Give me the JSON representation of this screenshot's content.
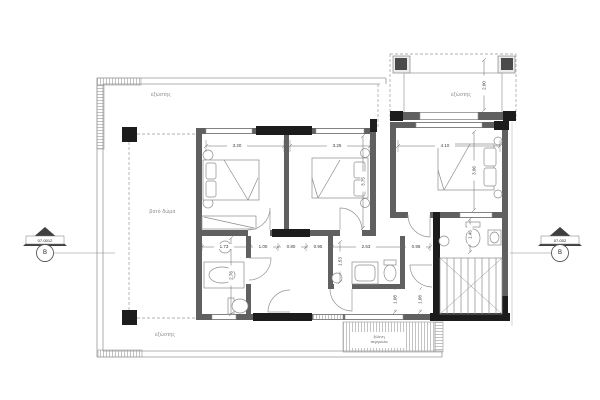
{
  "plan": {
    "labels": {
      "terrace_top": "εξώστης",
      "balcony": "εξώστης",
      "roof_deck": "βατό δώμα",
      "terrace_bottom": "εξώστης",
      "pergola_line1": "ξύλινη",
      "pergola_line2": "πέργκολα"
    },
    "section_markers": {
      "left": {
        "code": "07-0012",
        "letter": "Β"
      },
      "right": {
        "code": "07-002",
        "letter": "Β"
      }
    },
    "dimensions": {
      "bed1_width": "3.20",
      "bed2_width": "3.25",
      "bed3_width": "4.10",
      "balcony_depth": "2.00",
      "bed2_depth": "3.75",
      "bed3_depth": "3.06",
      "bath1_width": "1.73",
      "hall_1": "1.00",
      "hall_2": "0.80",
      "offset_left": "0.95",
      "bath2_width": "2.53",
      "offset_right": "0.95",
      "bath1_depth": "2.76",
      "bath2_depth": "1.53",
      "bath3_depth": "1.45",
      "entry_left": "1.08",
      "entry_right": "1.08"
    },
    "colors": {
      "wall": "#606060",
      "column": "#1c1c1c",
      "lines": "#9a9a9a",
      "background": "#ffffff"
    }
  }
}
